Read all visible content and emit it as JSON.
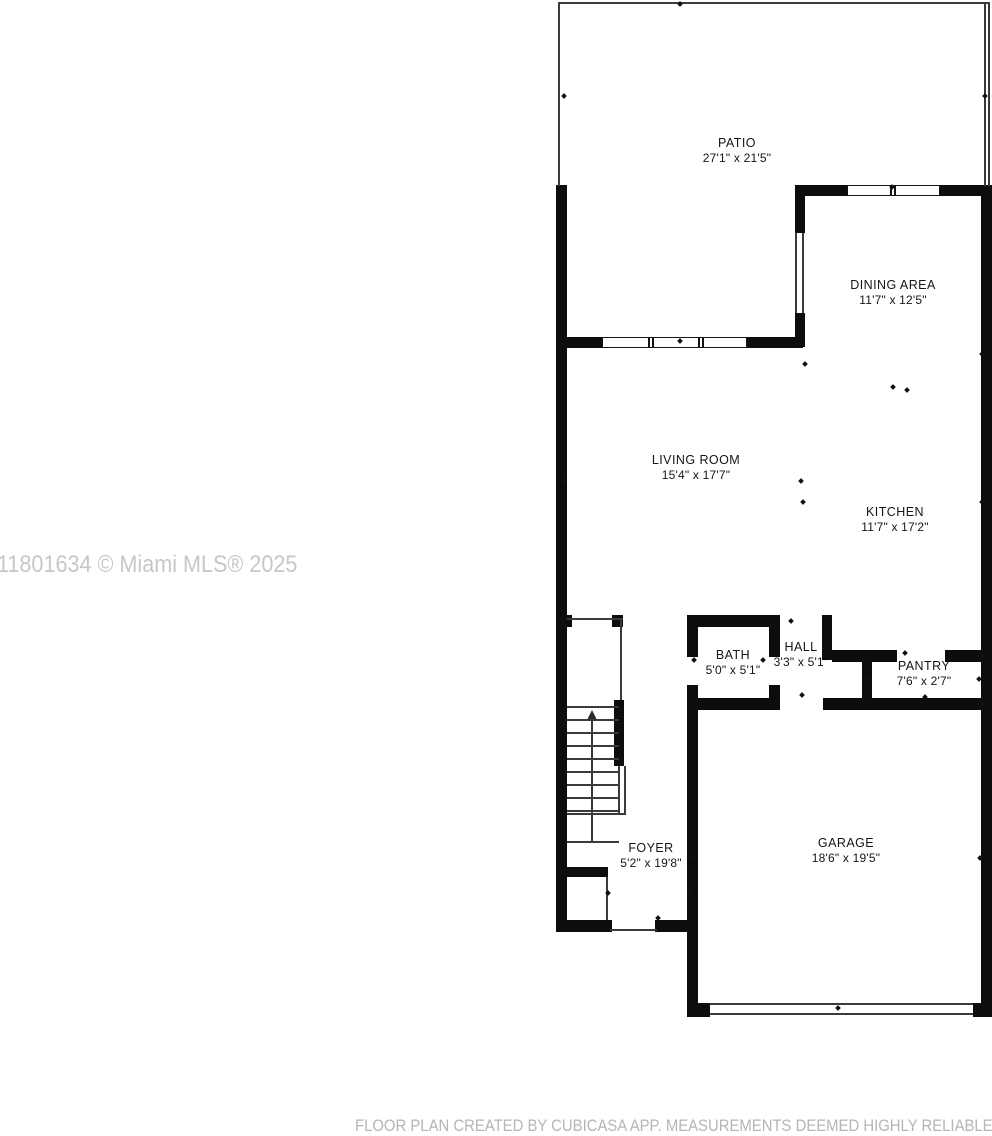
{
  "watermark": "11801634 © Miami MLS® 2025",
  "footer": "FLOOR PLAN CREATED BY CUBICASA APP. MEASUREMENTS DEEMED HIGHLY RELIABLE",
  "colors": {
    "wall": "#0d0d0d",
    "thin_line": "#3a3a3a",
    "watermark": "#c7c7c7",
    "footer": "#b5b5b5",
    "background": "#ffffff"
  },
  "rooms": [
    {
      "name": "PATIO",
      "dims": "27'1\" x 21'5\""
    },
    {
      "name": "DINING AREA",
      "dims": "11'7\" x 12'5\""
    },
    {
      "name": "LIVING ROOM",
      "dims": "15'4\" x 17'7\""
    },
    {
      "name": "KITCHEN",
      "dims": "11'7\" x 17'2\""
    },
    {
      "name": "BATH",
      "dims": "5'0\" x 5'1\""
    },
    {
      "name": "HALL",
      "dims": "3'3\" x 5'1\""
    },
    {
      "name": "PANTRY",
      "dims": "7'6\" x 2'7\""
    },
    {
      "name": "FOYER",
      "dims": "5'2\" x 19'8\""
    },
    {
      "name": "GARAGE",
      "dims": "18'6\" x 19'5\""
    }
  ]
}
